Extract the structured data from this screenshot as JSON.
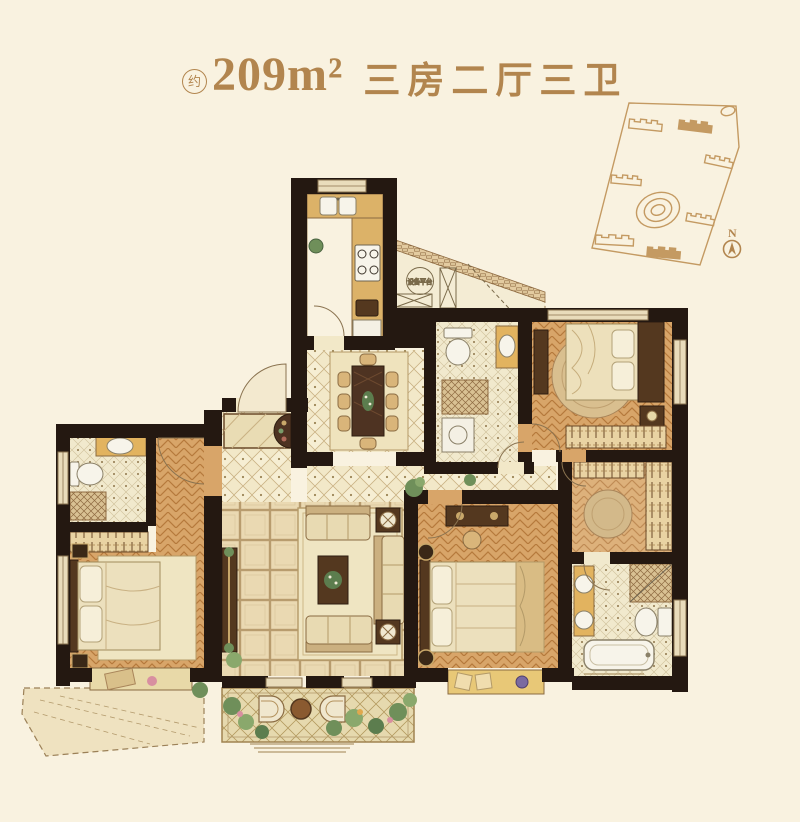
{
  "page": {
    "background": "#f9f2e0"
  },
  "header": {
    "approx_badge": "约",
    "area": "209m²",
    "layout_title": "三房二厅三卫",
    "accent_color": "#b2854e"
  },
  "floor_plan": {
    "equipment_platform_label": "设备平台",
    "wall_color": "#241811"
  },
  "site_map": {
    "compass_label": "N",
    "outline_color": "#c49a62"
  }
}
